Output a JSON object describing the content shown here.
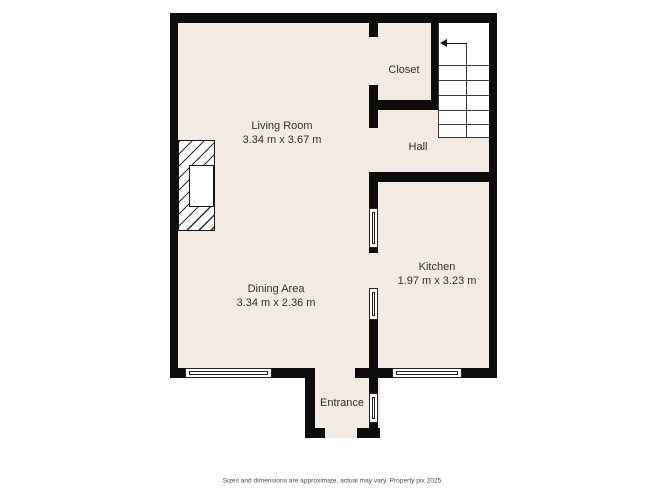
{
  "rooms": {
    "living_room": {
      "name": "Living Room",
      "dims": "3.34 m x 3.67 m"
    },
    "dining_area": {
      "name": "Dining Area",
      "dims": "3.34 m x 2.36 m"
    },
    "kitchen": {
      "name": "Kitchen",
      "dims": "1.97 m x 3.23 m"
    },
    "closet": {
      "name": "Closet"
    },
    "hall": {
      "name": "Hall"
    },
    "entrance": {
      "name": "Entrance"
    }
  },
  "disclaimer": "Sizes and dimensions are approximate, actual may vary. Property pix 2025",
  "colors": {
    "floor": "#f2ebe3",
    "wall": "#0c0c0c",
    "background": "#ffffff",
    "stairs_line": "#3a3a3a",
    "label_text": "#34302e",
    "disclaimer_text": "#4a4a4a"
  }
}
